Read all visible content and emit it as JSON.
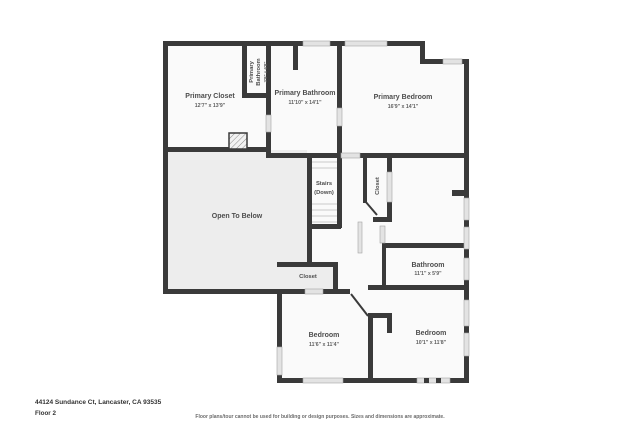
{
  "colors": {
    "wall": "#3a3a3a",
    "room_fill": "#fafafa",
    "void_fill": "#ededed",
    "window_fill": "#e3e3e3",
    "stair_tread": "#c9c9c9",
    "label_text": "#4d4d4d"
  },
  "floor_plan": {
    "rooms": {
      "primary_closet": {
        "name": "Primary Closet",
        "dims": "12'7\" x 13'9\""
      },
      "primary_bathroom_small": {
        "name_line1": "Primary",
        "name_line2": "Bathroom",
        "dims": "3'9\" x 6'8\""
      },
      "primary_bathroom": {
        "name": "Primary Bathroom",
        "dims": "11'10\" x 14'1\""
      },
      "primary_bedroom": {
        "name": "Primary Bedroom",
        "dims": "16'9\" x 14'1\""
      },
      "stairs": {
        "line1": "Stairs",
        "line2": "(Down)"
      },
      "hall_closet": {
        "name": "Closet"
      },
      "open_to_below": {
        "name": "Open To Below"
      },
      "bathroom": {
        "name": "Bathroom",
        "dims": "11'1\" x 5'9\""
      },
      "bedroom_closet": {
        "name": "Closet"
      },
      "bedroom_left": {
        "name": "Bedroom",
        "dims": "11'6\" x 11'4\""
      },
      "bedroom_right": {
        "name": "Bedroom",
        "dims": "10'1\" x 11'8\""
      }
    }
  },
  "footer": {
    "address": "44124 Sundance Ct, Lancaster, CA 93535",
    "floor_label": "Floor 2",
    "disclaimer": "Floor plans/tour cannot be used for building or design purposes. Sizes and dimensions are approximate."
  }
}
